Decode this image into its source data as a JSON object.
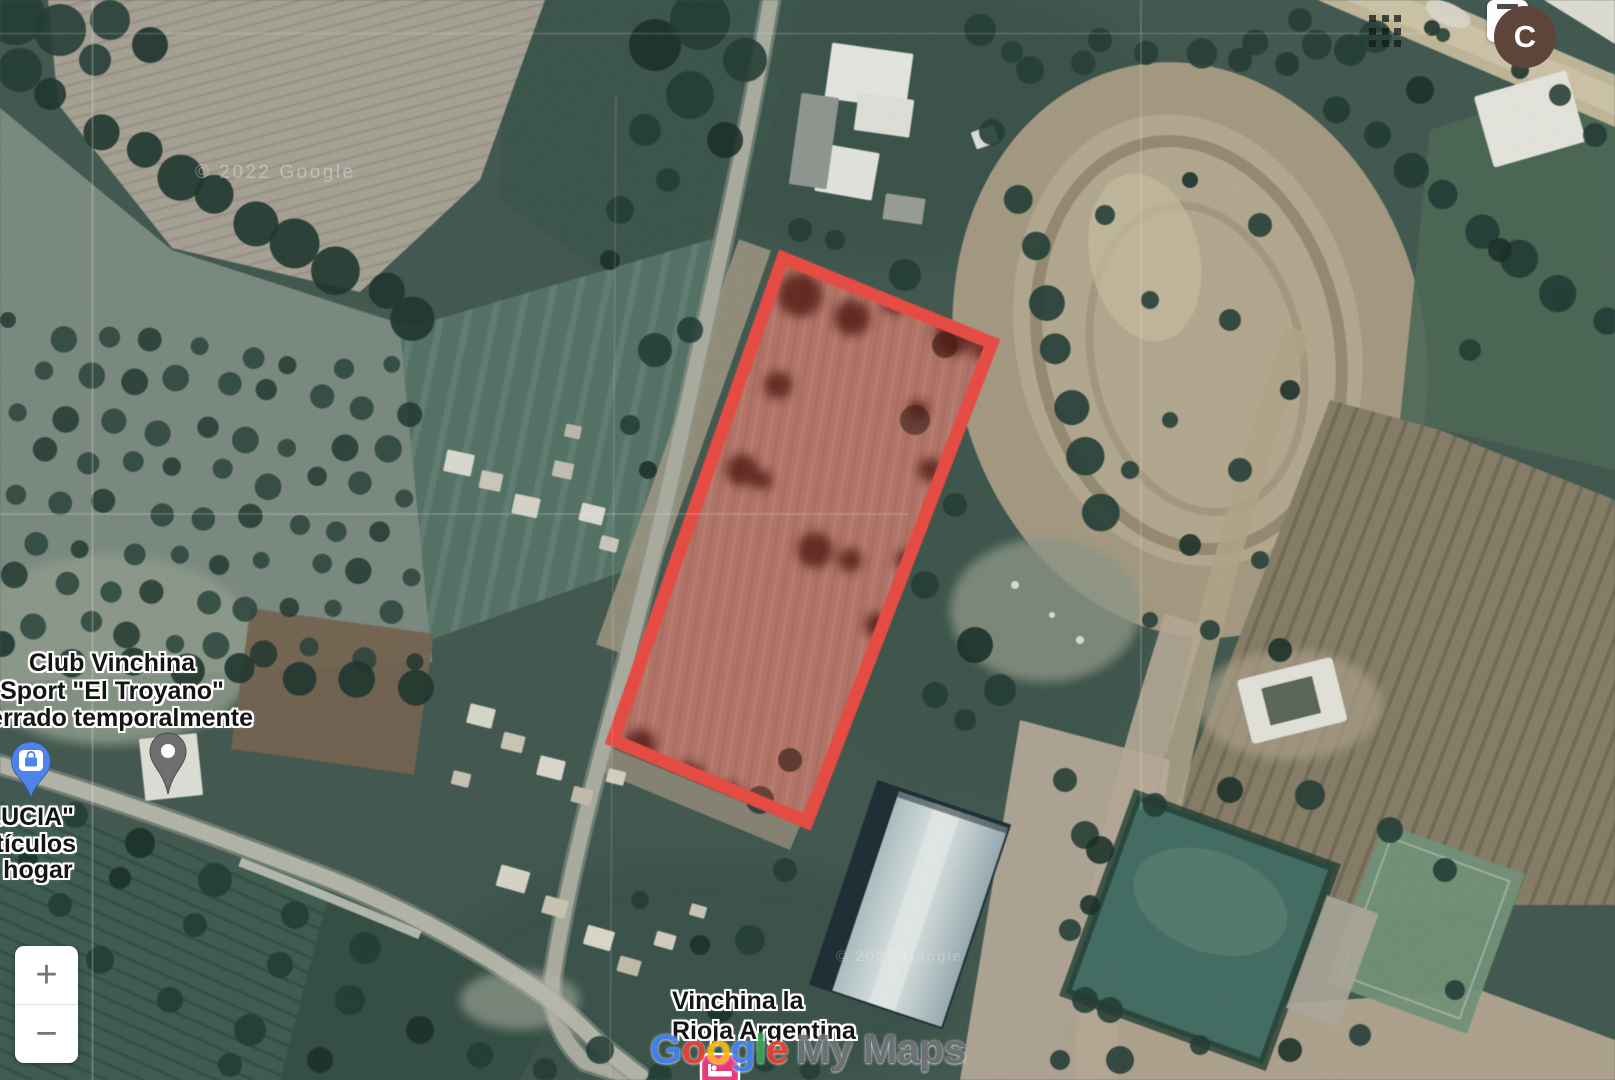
{
  "labels": {
    "club": [
      "Club Vinchina",
      "Sport \"El Troyano\"",
      "Cerrado temporalmente"
    ],
    "store": [
      "\"LUCIA\"",
      "artículos",
      "el hogar"
    ],
    "place": [
      "Vinchina la",
      "Rioja Argentina"
    ]
  },
  "watermark": {
    "brand": "Google",
    "brand_colors": [
      "#4285F4",
      "#EA4335",
      "#FBBC05",
      "#4285F4",
      "#34A853",
      "#EA4335"
    ],
    "suffix": "My Maps"
  },
  "imagery_credit": "© 2022 Google",
  "controls": {
    "zoom_in": "+",
    "zoom_out": "−"
  },
  "account": {
    "avatar_initial": "C"
  },
  "pins": {
    "store_pin_color": "#4E83EA",
    "club_pin_color": "#6F6F6F",
    "lodging_pin_color": "#E8397C"
  },
  "overlay": {
    "parcel_stroke": "#F75349",
    "parcel_fill": "rgba(242,63,50,0.30)"
  }
}
